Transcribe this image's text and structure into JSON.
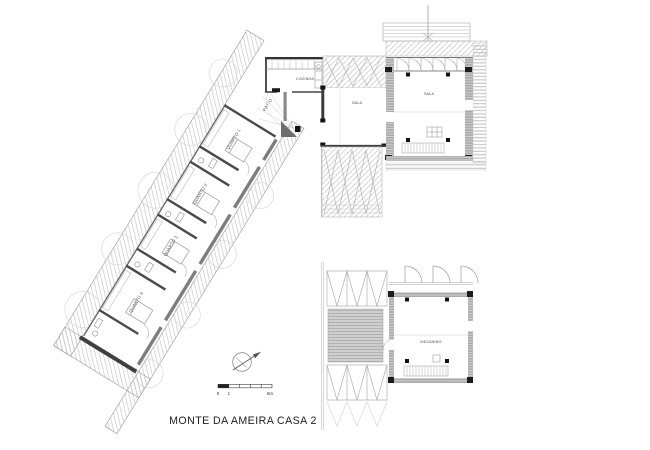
{
  "drawing": {
    "title": "MONTE DA AMEIRA CASA 2",
    "rooms": {
      "cozinha": "COZINHA",
      "patio": "PÁTIO",
      "sala_interior": "SALA",
      "sala_pavilion": "SALA",
      "mezanino": "MEZANINO",
      "quarto1": "QUARTO 1",
      "quarto2": "QUARTO 2",
      "quarto3": "QUARTO 3",
      "quarto4": "QUARTO 4"
    },
    "scale_bar": {
      "zero": "0",
      "one": "1",
      "five_m": "5m"
    },
    "symbols": {
      "north_arrow": "north-arrow",
      "scale_bar": "graphic-scale"
    },
    "colors": {
      "hatch": "#c6c6c6",
      "wall_dark": "#3c3c3c",
      "wall_black": "#1c1c1c",
      "wall_gray": "#ababab",
      "line": "#9a9a9a"
    }
  }
}
